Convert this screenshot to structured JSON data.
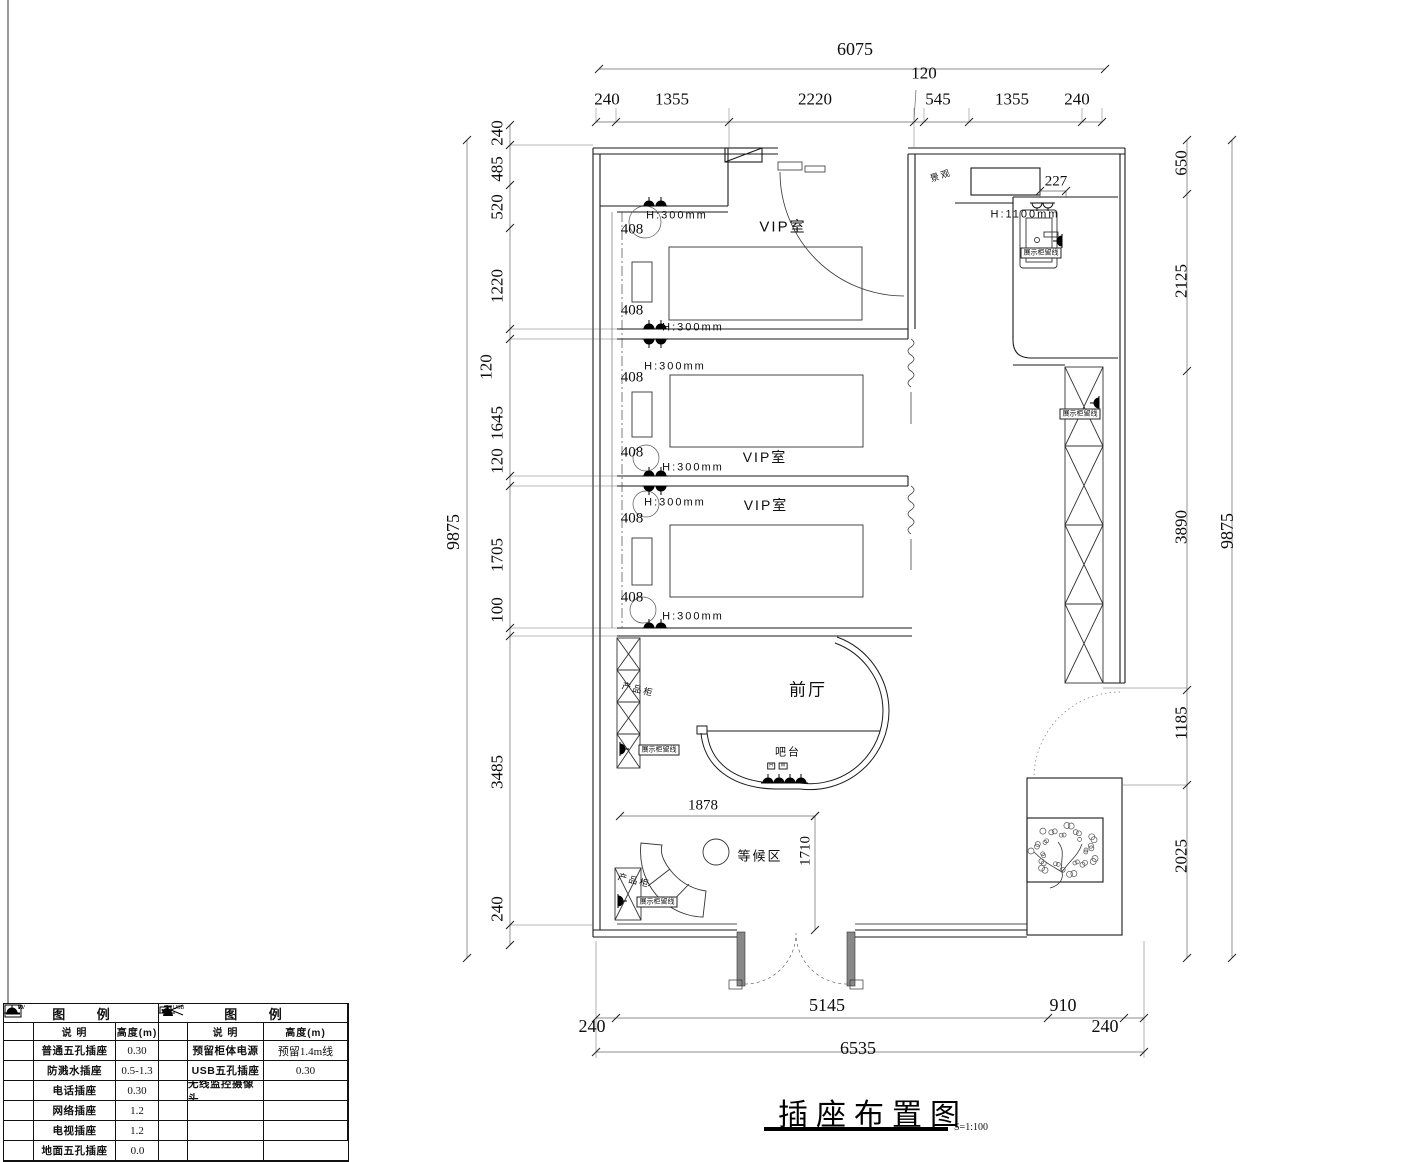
{
  "title": {
    "text": "插座布置图",
    "scale": "S=1:100"
  },
  "drawing": {
    "type": "floor-plan",
    "rooms": [
      "VIP室",
      "VIP室",
      "VIP室",
      "前厅",
      "等候区"
    ],
    "fixtures": [
      "吧台",
      "产品柜",
      "产品柜",
      "景观"
    ]
  },
  "labels": {
    "dims_top": [
      {
        "t": "6075",
        "x": 855,
        "y": 49,
        "s": 18
      },
      {
        "t": "240",
        "x": 607,
        "y": 99,
        "s": 17
      },
      {
        "t": "1355",
        "x": 672,
        "y": 99,
        "s": 17
      },
      {
        "t": "2220",
        "x": 815,
        "y": 99,
        "s": 17
      },
      {
        "t": "120",
        "x": 924,
        "y": 73,
        "s": 17
      },
      {
        "t": "545",
        "x": 938,
        "y": 99,
        "s": 17
      },
      {
        "t": "1355",
        "x": 1012,
        "y": 99,
        "s": 17
      },
      {
        "t": "240",
        "x": 1077,
        "y": 99,
        "s": 17
      }
    ],
    "dims_bottom": [
      {
        "t": "5145",
        "x": 827,
        "y": 1005,
        "s": 18
      },
      {
        "t": "910",
        "x": 1063,
        "y": 1005,
        "s": 18
      },
      {
        "t": "240",
        "x": 592,
        "y": 1026,
        "s": 18
      },
      {
        "t": "240",
        "x": 1105,
        "y": 1026,
        "s": 18
      },
      {
        "t": "6535",
        "x": 858,
        "y": 1048,
        "s": 18
      }
    ],
    "dims_left": [
      {
        "t": "240",
        "x": 497,
        "y": 133,
        "s": 17
      },
      {
        "t": "485",
        "x": 497,
        "y": 169,
        "s": 17
      },
      {
        "t": "520",
        "x": 497,
        "y": 207,
        "s": 17
      },
      {
        "t": "1220",
        "x": 497,
        "y": 286,
        "s": 17
      },
      {
        "t": "120",
        "x": 486,
        "y": 367,
        "s": 17
      },
      {
        "t": "1645",
        "x": 497,
        "y": 423,
        "s": 17
      },
      {
        "t": "120",
        "x": 497,
        "y": 461,
        "s": 17
      },
      {
        "t": "1705",
        "x": 497,
        "y": 555,
        "s": 17
      },
      {
        "t": "100",
        "x": 497,
        "y": 610,
        "s": 17
      },
      {
        "t": "3485",
        "x": 497,
        "y": 772,
        "s": 17
      },
      {
        "t": "240",
        "x": 497,
        "y": 909,
        "s": 17
      },
      {
        "t": "9875",
        "x": 453,
        "y": 532,
        "s": 18
      }
    ],
    "dims_right": [
      {
        "t": "650",
        "x": 1181,
        "y": 163,
        "s": 17
      },
      {
        "t": "2125",
        "x": 1181,
        "y": 281,
        "s": 17
      },
      {
        "t": "3890",
        "x": 1181,
        "y": 527,
        "s": 17
      },
      {
        "t": "1185",
        "x": 1181,
        "y": 723,
        "s": 17
      },
      {
        "t": "2025",
        "x": 1181,
        "y": 856,
        "s": 17
      },
      {
        "t": "9875",
        "x": 1227,
        "y": 531,
        "s": 18
      }
    ],
    "dims_inner": [
      {
        "t": "408",
        "x": 632,
        "y": 230,
        "s": 15
      },
      {
        "t": "408",
        "x": 632,
        "y": 311,
        "s": 15
      },
      {
        "t": "408",
        "x": 632,
        "y": 378,
        "s": 15
      },
      {
        "t": "408",
        "x": 632,
        "y": 453,
        "s": 15
      },
      {
        "t": "408",
        "x": 632,
        "y": 519,
        "s": 15
      },
      {
        "t": "408",
        "x": 632,
        "y": 598,
        "s": 15
      },
      {
        "t": "227",
        "x": 1056,
        "y": 182,
        "s": 15
      },
      {
        "t": "1878",
        "x": 703,
        "y": 806,
        "s": 15
      },
      {
        "t": "1710",
        "x": 806,
        "y": 851,
        "s": 15,
        "rot": true
      }
    ],
    "rooms": [
      {
        "t": "VIP室",
        "x": 783,
        "y": 227,
        "s": 15
      },
      {
        "t": "VIP室",
        "x": 765,
        "y": 457,
        "s": 14
      },
      {
        "t": "VIP室",
        "x": 766,
        "y": 505,
        "s": 14
      },
      {
        "t": "前厅",
        "x": 808,
        "y": 690,
        "s": 17
      },
      {
        "t": "吧台",
        "x": 788,
        "y": 753,
        "s": 11
      },
      {
        "t": "等候区",
        "x": 760,
        "y": 856,
        "s": 13
      },
      {
        "t": "景观",
        "x": 941,
        "y": 176,
        "s": 9,
        "slant2": true
      },
      {
        "t": "产品柜",
        "x": 638,
        "y": 690,
        "s": 9,
        "slant": true
      },
      {
        "t": "产品柜",
        "x": 634,
        "y": 881,
        "s": 9,
        "slant": true
      }
    ],
    "heights": [
      {
        "t": "H:300mm",
        "x": 677,
        "y": 216,
        "s": 11
      },
      {
        "t": "H:300mm",
        "x": 693,
        "y": 328,
        "s": 11
      },
      {
        "t": "H:300mm",
        "x": 675,
        "y": 367,
        "s": 11
      },
      {
        "t": "H:300mm",
        "x": 693,
        "y": 468,
        "s": 11
      },
      {
        "t": "H:300mm",
        "x": 675,
        "y": 503,
        "s": 11
      },
      {
        "t": "H:300mm",
        "x": 693,
        "y": 617,
        "s": 11
      },
      {
        "t": "H:1100mm",
        "x": 1025,
        "y": 215,
        "s": 11
      }
    ],
    "boxed": [
      {
        "t": "展示柜留线",
        "x": 659,
        "y": 750,
        "s": 7
      },
      {
        "t": "展示柜留线",
        "x": 657,
        "y": 902,
        "s": 7
      },
      {
        "t": "展示柜留线",
        "x": 1080,
        "y": 414,
        "s": 7
      },
      {
        "t": "展示柜留线",
        "x": 1041,
        "y": 253,
        "s": 7
      }
    ],
    "tiny": [
      {
        "t": "H",
        "x": 771,
        "y": 766,
        "s": 5
      },
      {
        "t": "W",
        "x": 783,
        "y": 766,
        "s": 5
      }
    ]
  },
  "legend_left": {
    "header": "图  例",
    "columns": [
      "",
      "说 明",
      "高度(m)"
    ],
    "rows": [
      {
        "sym": "socket",
        "symname": "five-hole-socket-icon",
        "desc": "普通五孔插座",
        "h": "0.30"
      },
      {
        "sym": "splash",
        "symname": "splash-proof-socket-icon",
        "desc": "防溅水插座",
        "h": "0.5-1.3"
      },
      {
        "sym": "phone",
        "symname": "phone-socket-icon",
        "desc": "电话插座",
        "h": "0.30"
      },
      {
        "sym": "net",
        "symname": "network-socket-icon",
        "desc": "网络插座",
        "h": "1.2"
      },
      {
        "sym": "tv",
        "symname": "tv-socket-icon",
        "desc": "电视插座",
        "h": "1.2"
      },
      {
        "sym": "floor",
        "symname": "floor-socket-icon",
        "desc": "地面五孔插座",
        "h": "0.0"
      }
    ]
  },
  "legend_right": {
    "header": "图  例",
    "columns": [
      "",
      "说 明",
      "高度(m)"
    ],
    "rows": [
      {
        "sym": "reserve",
        "symname": "reserved-cabinet-power-icon",
        "desc": "预留柜体电源",
        "h": "预留1.4m线"
      },
      {
        "sym": "usb",
        "symname": "usb-socket-icon",
        "desc": "USB五孔插座",
        "h": "0.30"
      },
      {
        "sym": "camera",
        "symname": "wireless-camera-icon",
        "desc": "无线监控摄像头",
        "h": ""
      },
      {
        "sym": "",
        "symname": "",
        "desc": "",
        "h": ""
      },
      {
        "sym": "",
        "symname": "",
        "desc": "",
        "h": ""
      },
      {
        "sym": "",
        "symname": "",
        "desc": "",
        "h": ""
      }
    ]
  }
}
